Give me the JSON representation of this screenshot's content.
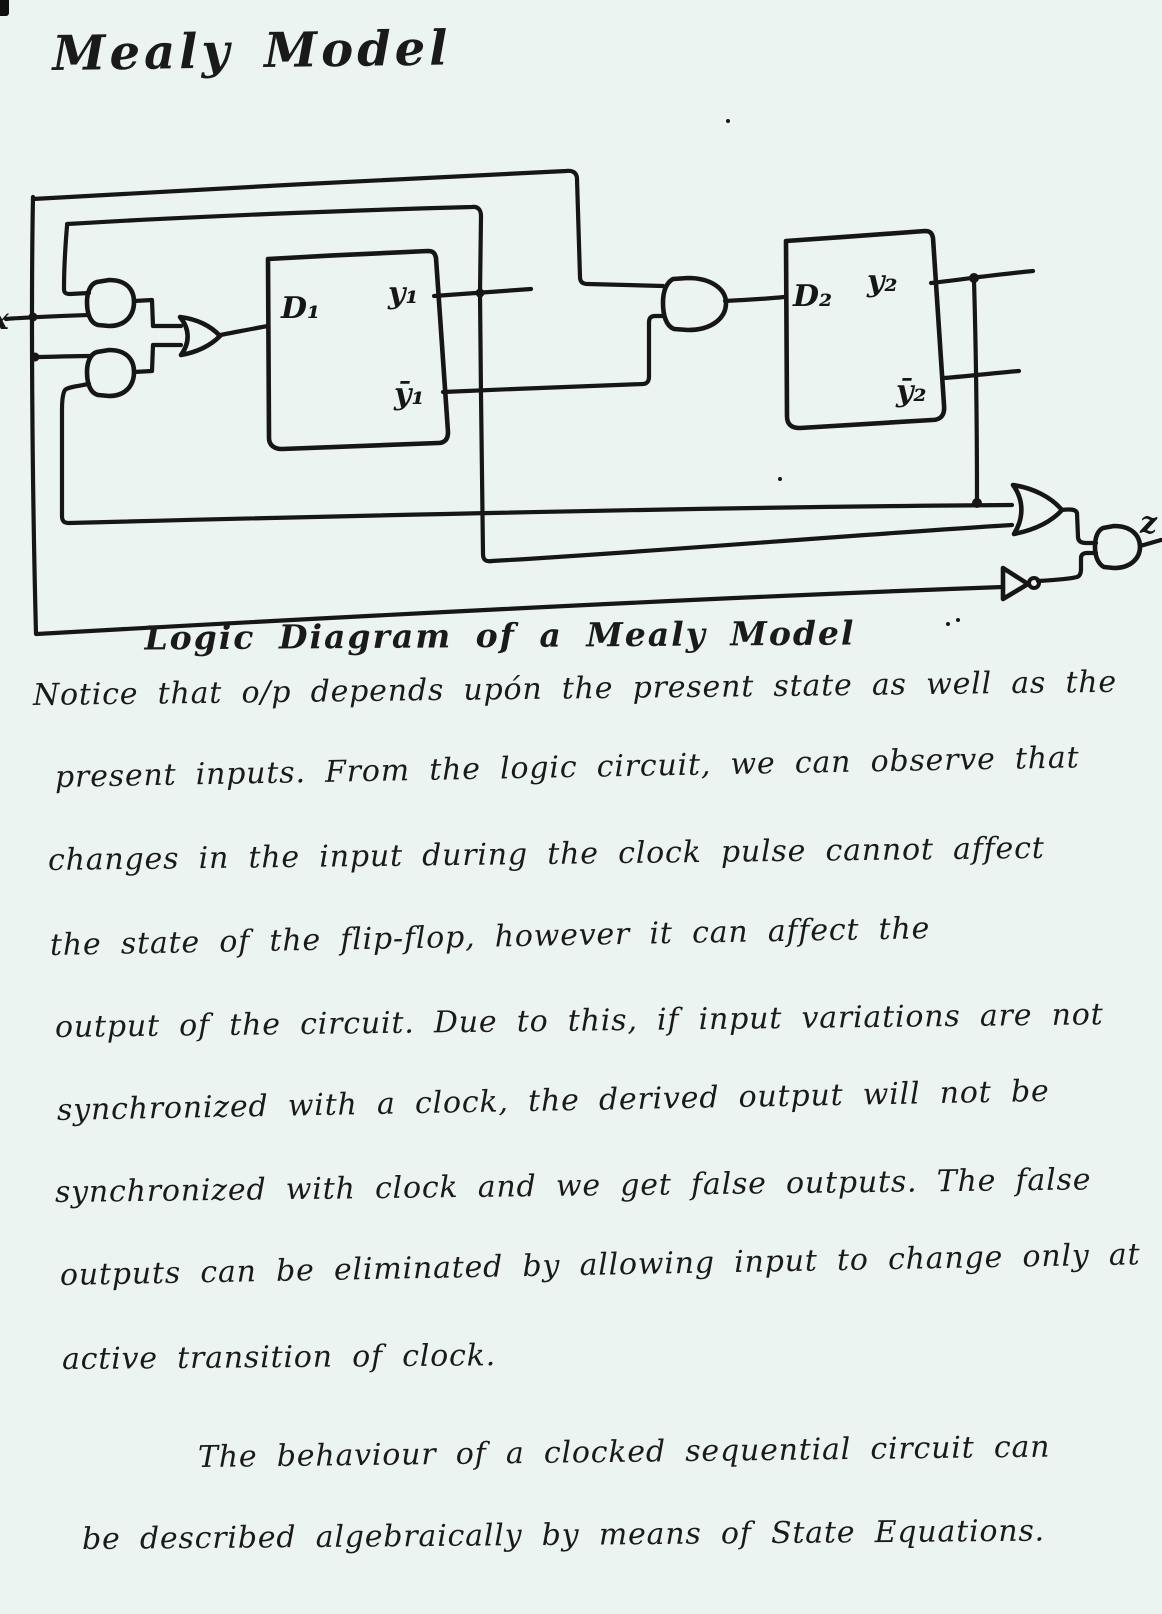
{
  "page": {
    "title": "Mealy Model",
    "background_color": "#ebf4f0",
    "ink_color": "#161616"
  },
  "diagram": {
    "caption": "Logic Diagram of a Mealy Model",
    "input_label": "x",
    "output_label": "z",
    "flipflop1": {
      "input": "D₁",
      "output": "y₁",
      "output_complement": "ȳ₁"
    },
    "flipflop2": {
      "input": "D₂",
      "output": "y₂",
      "output_complement": "ȳ₂"
    }
  },
  "notes": {
    "lines": [
      "Notice that o/p depends upón the present state as well as the",
      "present inputs. From the logic circuit, we can observe that",
      "changes in the input during the clock pulse cannot affect",
      "the state of the flip-flop, however it can affect the",
      "output of the circuit. Due to this, if input variations are not",
      "synchronized with a clock, the derived output will not be",
      "synchronized with clock and we get false outputs. The false",
      "outputs can be eliminated by allowing input to change only at",
      "active transition of clock.",
      "The behaviour of a clocked sequential circuit can",
      "be described algebraically by means of State Equations."
    ]
  }
}
